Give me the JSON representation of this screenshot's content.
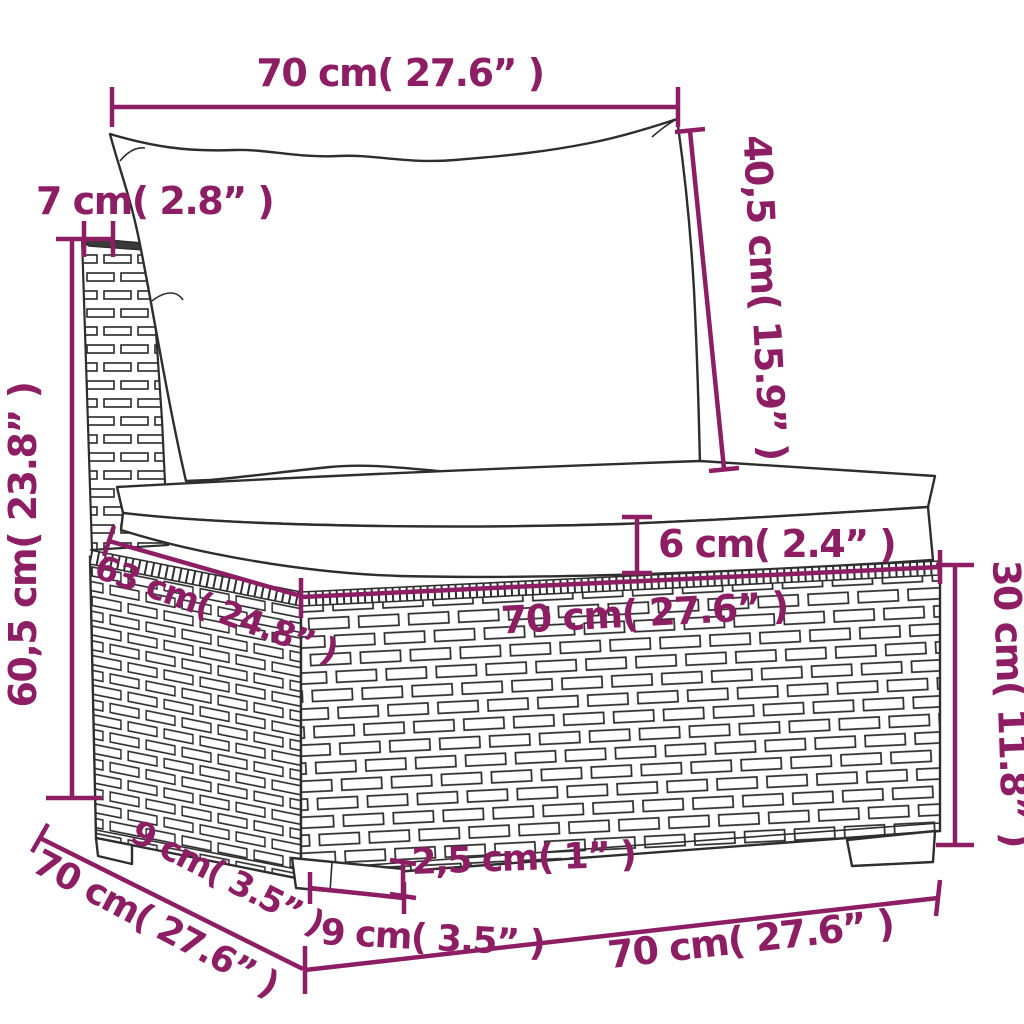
{
  "diagram": {
    "accent_color": "#8D1E64",
    "line_color": "#2e2e2e",
    "labels": {
      "top_width": "70 cm( 27.6” )",
      "back_cushion_height": "40,5 cm( 15.9” )",
      "back_thickness": "7 cm( 2.8” )",
      "overall_height": "60,5 cm( 23.8” )",
      "cushion_thickness": "6 cm( 2.4” )",
      "seat_depth": "63 cm( 24.8” )",
      "seat_width": "70 cm( 27.6” )",
      "base_height": "30 cm( 11.8” )",
      "side_foot_inset": "9 cm( 3.5” )",
      "side_depth": "70 cm( 27.6” )",
      "foot_height": "2,5 cm( 1” )",
      "foot_width": "9 cm( 3.5” )",
      "bottom_width": "70 cm( 27.6” )"
    }
  }
}
